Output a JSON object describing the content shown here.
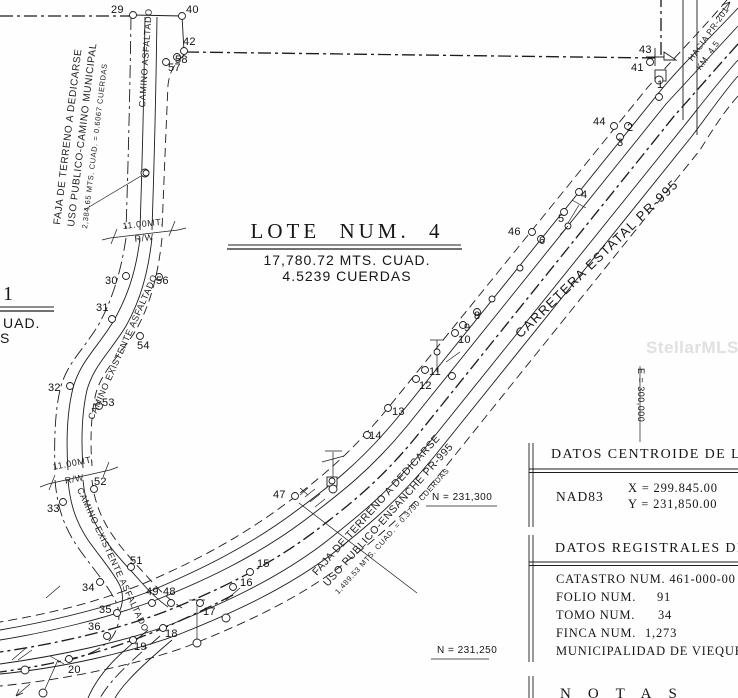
{
  "watermark": {
    "text": "StellarMLS"
  },
  "title_block": {
    "title": "LOTE NUM. 4",
    "area_m": "17,780.72 MTS. CUAD.",
    "area_c": "4.5239 CUERDAS"
  },
  "left_partial_title": {
    "big": "1",
    "frag1": "UAD.",
    "frag2": "S"
  },
  "road_labels": {
    "faja_municipal_1": "FAJA DE TERRENO A DEDICARSE",
    "faja_municipal_2": "USO PUBLICO-CAMINO MUNICIPAL",
    "faja_municipal_3": "2,384.65 MTS. CUAD. = 0.6067 CUERDAS",
    "camino_asfaltado": "CAMINO ASFALTADO",
    "camino_existente_1": "CAMINO EXISTENTE ASFALTADO",
    "camino_existente_2": "CAMINO EXISTENTE ASFALTADO",
    "carretera": "CARRETERA ESTATAL PR-995",
    "hacia": "HACIA PR-201",
    "km": "KM. 4.5",
    "ensanche_1": "FAJA DE TERRENO A DEDICARSE",
    "ensanche_2": "USO PUBLICO-ENSANCHE PR-995",
    "ensanche_3": "1,489.53 MTS. CUAD. = 0.3790 CUERDAS",
    "rw_top_dim": "11.00MT.",
    "rw_top_rw": "R/W",
    "rw_mid_dim": "11.00MT.",
    "rw_mid_rw": "R/W"
  },
  "grid_labels": {
    "n_upper": "N = 231,300",
    "n_lower": "N = 231,250",
    "e_right": "E = 300,000"
  },
  "tables": {
    "centroide": {
      "title": "DATOS CENTROIDE DE LA",
      "datum": "NAD83",
      "x": "X = 299.845.00",
      "y": "Y = 231,850.00"
    },
    "registrales": {
      "title": "DATOS REGISTRALES DE",
      "row1_label": "CATASTRO NUM.",
      "row1_value": "461-000-00",
      "row2_label": "FOLIO NUM.",
      "row2_value": "91",
      "row3_label": "TOMO NUM.",
      "row3_value": "34",
      "row4_label": "FINCA NUM.",
      "row4_value": "1,273",
      "row5": "MUNICIPALIDAD DE VIEQUES"
    },
    "notas_title": "NOTAS"
  },
  "points": {
    "p1": "1",
    "p2": "2",
    "p3": "3",
    "p4": "4",
    "p5": "5",
    "p6": "6",
    "p8": "8",
    "p9": "9",
    "p10": "10",
    "p11": "11",
    "p12": "12",
    "p13": "13",
    "p14": "14",
    "p15": "15",
    "p16": "16",
    "p17": "17",
    "p18": "18",
    "p19": "19",
    "p20": "20",
    "p29": "29",
    "p30": "30",
    "p31": "31",
    "p32": "32",
    "p33": "33",
    "p34": "34",
    "p35": "35",
    "p36": "36",
    "p40": "40",
    "p41": "41",
    "p42": "42",
    "p43": "43",
    "p44": "44",
    "p46": "46",
    "p47": "47",
    "p48": "48",
    "p49": "49",
    "p51": "51",
    "p52": "52",
    "p53": "53",
    "p54": "54",
    "p56": "56",
    "p57": "57",
    "p58": "58"
  }
}
